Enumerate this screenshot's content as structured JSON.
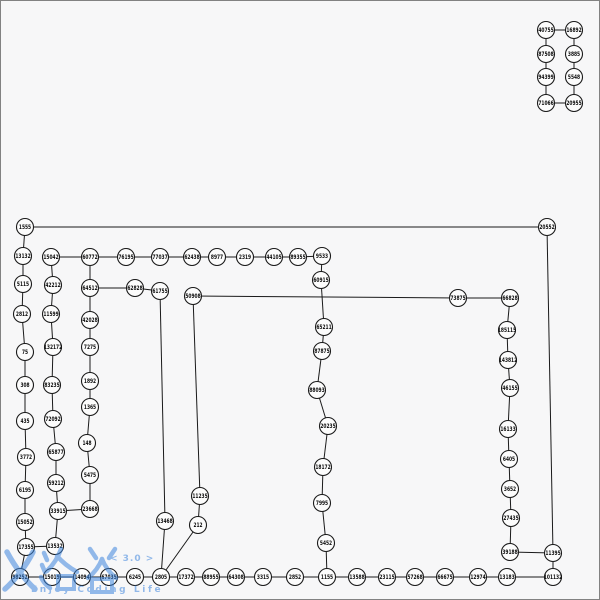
{
  "canvas": {
    "width": 600,
    "height": 600,
    "background": "#f7f7f8",
    "border_color": "#828282"
  },
  "watermark": {
    "logo_text": "乂洛谷",
    "version": "< 3.0 >",
    "slogan": "Enjoy Coding Life",
    "color": "#3f86dd"
  },
  "graph": {
    "style": {
      "node_radius": 8.5,
      "node_fill": "#fcfcfc",
      "node_stroke": "#1a1a1a",
      "node_stroke_width": 1.1,
      "edge_color": "#1a1a1a",
      "edge_width": 1,
      "label_size": 6
    },
    "nodes": [
      {
        "id": "40755",
        "x": 546,
        "y": 30
      },
      {
        "id": "16892",
        "x": 574,
        "y": 30
      },
      {
        "id": "87508",
        "x": 546,
        "y": 54
      },
      {
        "id": "3885",
        "x": 574,
        "y": 54
      },
      {
        "id": "94399",
        "x": 546,
        "y": 77
      },
      {
        "id": "5548",
        "x": 574,
        "y": 77
      },
      {
        "id": "71066",
        "x": 546,
        "y": 103
      },
      {
        "id": "20955",
        "x": 574,
        "y": 103
      },
      {
        "id": "1555",
        "x": 25,
        "y": 227
      },
      {
        "id": "20552",
        "x": 547,
        "y": 227
      },
      {
        "id": "13132",
        "x": 23,
        "y": 256
      },
      {
        "id": "15042",
        "x": 51,
        "y": 257
      },
      {
        "id": "60772",
        "x": 90,
        "y": 257
      },
      {
        "id": "76195",
        "x": 126,
        "y": 257
      },
      {
        "id": "77037",
        "x": 160,
        "y": 257
      },
      {
        "id": "62438",
        "x": 192,
        "y": 257
      },
      {
        "id": "8977",
        "x": 217,
        "y": 257
      },
      {
        "id": "2319",
        "x": 245,
        "y": 257
      },
      {
        "id": "44105",
        "x": 274,
        "y": 257
      },
      {
        "id": "89355",
        "x": 298,
        "y": 257
      },
      {
        "id": "9533",
        "x": 322,
        "y": 256
      },
      {
        "id": "5115",
        "x": 23,
        "y": 284
      },
      {
        "id": "42212",
        "x": 53,
        "y": 285
      },
      {
        "id": "64512",
        "x": 90,
        "y": 288
      },
      {
        "id": "62828",
        "x": 135,
        "y": 288
      },
      {
        "id": "61755",
        "x": 160,
        "y": 291
      },
      {
        "id": "50908",
        "x": 193,
        "y": 296
      },
      {
        "id": "73875",
        "x": 458,
        "y": 298
      },
      {
        "id": "66828",
        "x": 510,
        "y": 298
      },
      {
        "id": "2812",
        "x": 22,
        "y": 314
      },
      {
        "id": "11599",
        "x": 51,
        "y": 314
      },
      {
        "id": "42028",
        "x": 90,
        "y": 320
      },
      {
        "id": "60915",
        "x": 321,
        "y": 280
      },
      {
        "id": "65211",
        "x": 324,
        "y": 327
      },
      {
        "id": "185115",
        "x": 507,
        "y": 330
      },
      {
        "id": "75",
        "x": 25,
        "y": 352
      },
      {
        "id": "132172",
        "x": 53,
        "y": 347
      },
      {
        "id": "7275",
        "x": 90,
        "y": 347
      },
      {
        "id": "87875",
        "x": 322,
        "y": 351
      },
      {
        "id": "143812",
        "x": 508,
        "y": 360
      },
      {
        "id": "308",
        "x": 25,
        "y": 385
      },
      {
        "id": "83235",
        "x": 52,
        "y": 385
      },
      {
        "id": "1892",
        "x": 90,
        "y": 381
      },
      {
        "id": "88093",
        "x": 317,
        "y": 390
      },
      {
        "id": "46155",
        "x": 510,
        "y": 388
      },
      {
        "id": "435",
        "x": 25,
        "y": 421
      },
      {
        "id": "72092",
        "x": 53,
        "y": 419
      },
      {
        "id": "1365",
        "x": 90,
        "y": 407
      },
      {
        "id": "20235",
        "x": 328,
        "y": 426
      },
      {
        "id": "16133",
        "x": 508,
        "y": 429
      },
      {
        "id": "3772",
        "x": 26,
        "y": 457
      },
      {
        "id": "65877",
        "x": 56,
        "y": 452
      },
      {
        "id": "148",
        "x": 87,
        "y": 443
      },
      {
        "id": "18172",
        "x": 323,
        "y": 467
      },
      {
        "id": "6405",
        "x": 509,
        "y": 459
      },
      {
        "id": "6195",
        "x": 25,
        "y": 490
      },
      {
        "id": "59212",
        "x": 56,
        "y": 483
      },
      {
        "id": "5475",
        "x": 90,
        "y": 475
      },
      {
        "id": "11235",
        "x": 200,
        "y": 496
      },
      {
        "id": "7995",
        "x": 322,
        "y": 503
      },
      {
        "id": "3652",
        "x": 510,
        "y": 489
      },
      {
        "id": "15052",
        "x": 25,
        "y": 522
      },
      {
        "id": "33915",
        "x": 58,
        "y": 511
      },
      {
        "id": "23668",
        "x": 90,
        "y": 509
      },
      {
        "id": "13468",
        "x": 165,
        "y": 521
      },
      {
        "id": "212",
        "x": 198,
        "y": 525
      },
      {
        "id": "27435",
        "x": 511,
        "y": 518
      },
      {
        "id": "17355",
        "x": 26,
        "y": 547
      },
      {
        "id": "13532",
        "x": 55,
        "y": 546
      },
      {
        "id": "5452",
        "x": 326,
        "y": 543
      },
      {
        "id": "39188",
        "x": 510,
        "y": 552
      },
      {
        "id": "11395",
        "x": 553,
        "y": 553
      },
      {
        "id": "98252",
        "x": 20,
        "y": 577
      },
      {
        "id": "15019",
        "x": 52,
        "y": 577
      },
      {
        "id": "14094",
        "x": 82,
        "y": 577
      },
      {
        "id": "67035",
        "x": 109,
        "y": 577
      },
      {
        "id": "6245",
        "x": 135,
        "y": 577
      },
      {
        "id": "2805",
        "x": 161,
        "y": 577
      },
      {
        "id": "17372",
        "x": 186,
        "y": 577
      },
      {
        "id": "88955",
        "x": 211,
        "y": 577
      },
      {
        "id": "64308",
        "x": 236,
        "y": 577
      },
      {
        "id": "3315",
        "x": 263,
        "y": 577
      },
      {
        "id": "2852",
        "x": 295,
        "y": 577
      },
      {
        "id": "1155",
        "x": 327,
        "y": 577
      },
      {
        "id": "13588",
        "x": 357,
        "y": 577
      },
      {
        "id": "23115",
        "x": 387,
        "y": 577
      },
      {
        "id": "57268",
        "x": 415,
        "y": 577
      },
      {
        "id": "66675",
        "x": 445,
        "y": 577
      },
      {
        "id": "12974",
        "x": 478,
        "y": 577
      },
      {
        "id": "13183",
        "x": 507,
        "y": 577
      },
      {
        "id": "101132",
        "x": 553,
        "y": 577
      }
    ],
    "edges": [
      [
        "40755",
        "16892"
      ],
      [
        "40755",
        "87508"
      ],
      [
        "16892",
        "3885"
      ],
      [
        "87508",
        "94399"
      ],
      [
        "3885",
        "5548"
      ],
      [
        "94399",
        "71066"
      ],
      [
        "5548",
        "20955"
      ],
      [
        "71066",
        "20955"
      ],
      [
        "1555",
        "20552"
      ],
      [
        "1555",
        "13132"
      ],
      [
        "13132",
        "5115"
      ],
      [
        "5115",
        "2812"
      ],
      [
        "2812",
        "75"
      ],
      [
        "75",
        "308"
      ],
      [
        "308",
        "435"
      ],
      [
        "435",
        "3772"
      ],
      [
        "3772",
        "6195"
      ],
      [
        "6195",
        "15052"
      ],
      [
        "15052",
        "17355"
      ],
      [
        "17355",
        "98252"
      ],
      [
        "15042",
        "42212"
      ],
      [
        "42212",
        "11599"
      ],
      [
        "11599",
        "132172"
      ],
      [
        "132172",
        "83235"
      ],
      [
        "83235",
        "72092"
      ],
      [
        "72092",
        "65877"
      ],
      [
        "65877",
        "59212"
      ],
      [
        "59212",
        "33915"
      ],
      [
        "33915",
        "13532"
      ],
      [
        "33915",
        "23668"
      ],
      [
        "17355",
        "13532"
      ],
      [
        "15042",
        "60772"
      ],
      [
        "60772",
        "76195"
      ],
      [
        "76195",
        "77037"
      ],
      [
        "77037",
        "62438"
      ],
      [
        "62438",
        "8977"
      ],
      [
        "8977",
        "2319"
      ],
      [
        "2319",
        "44105"
      ],
      [
        "44105",
        "89355"
      ],
      [
        "89355",
        "9533"
      ],
      [
        "60772",
        "64512"
      ],
      [
        "64512",
        "62828"
      ],
      [
        "62828",
        "61755"
      ],
      [
        "64512",
        "42028"
      ],
      [
        "42028",
        "7275"
      ],
      [
        "7275",
        "1892"
      ],
      [
        "1892",
        "1365"
      ],
      [
        "1365",
        "148"
      ],
      [
        "148",
        "5475"
      ],
      [
        "5475",
        "23668"
      ],
      [
        "61755",
        "13468"
      ],
      [
        "13468",
        "2805"
      ],
      [
        "50908",
        "11235"
      ],
      [
        "11235",
        "212"
      ],
      [
        "212",
        "2805"
      ],
      [
        "50908",
        "73875"
      ],
      [
        "9533",
        "60915"
      ],
      [
        "60915",
        "65211"
      ],
      [
        "65211",
        "87875"
      ],
      [
        "87875",
        "88093"
      ],
      [
        "88093",
        "20235"
      ],
      [
        "20235",
        "18172"
      ],
      [
        "18172",
        "7995"
      ],
      [
        "7995",
        "5452"
      ],
      [
        "5452",
        "1155"
      ],
      [
        "73875",
        "66828"
      ],
      [
        "66828",
        "185115"
      ],
      [
        "185115",
        "143812"
      ],
      [
        "143812",
        "46155"
      ],
      [
        "46155",
        "16133"
      ],
      [
        "16133",
        "6405"
      ],
      [
        "6405",
        "3652"
      ],
      [
        "3652",
        "27435"
      ],
      [
        "27435",
        "39188"
      ],
      [
        "39188",
        "11395"
      ],
      [
        "11395",
        "20552"
      ],
      [
        "11395",
        "101132"
      ],
      [
        "98252",
        "15019"
      ],
      [
        "15019",
        "14094"
      ],
      [
        "14094",
        "67035"
      ],
      [
        "67035",
        "6245"
      ],
      [
        "6245",
        "2805"
      ],
      [
        "2805",
        "17372"
      ],
      [
        "17372",
        "88955"
      ],
      [
        "88955",
        "64308"
      ],
      [
        "64308",
        "3315"
      ],
      [
        "3315",
        "2852"
      ],
      [
        "2852",
        "1155"
      ],
      [
        "1155",
        "13588"
      ],
      [
        "13588",
        "23115"
      ],
      [
        "23115",
        "57268"
      ],
      [
        "57268",
        "66675"
      ],
      [
        "66675",
        "12974"
      ],
      [
        "12974",
        "13183"
      ],
      [
        "13183",
        "101132"
      ]
    ]
  }
}
